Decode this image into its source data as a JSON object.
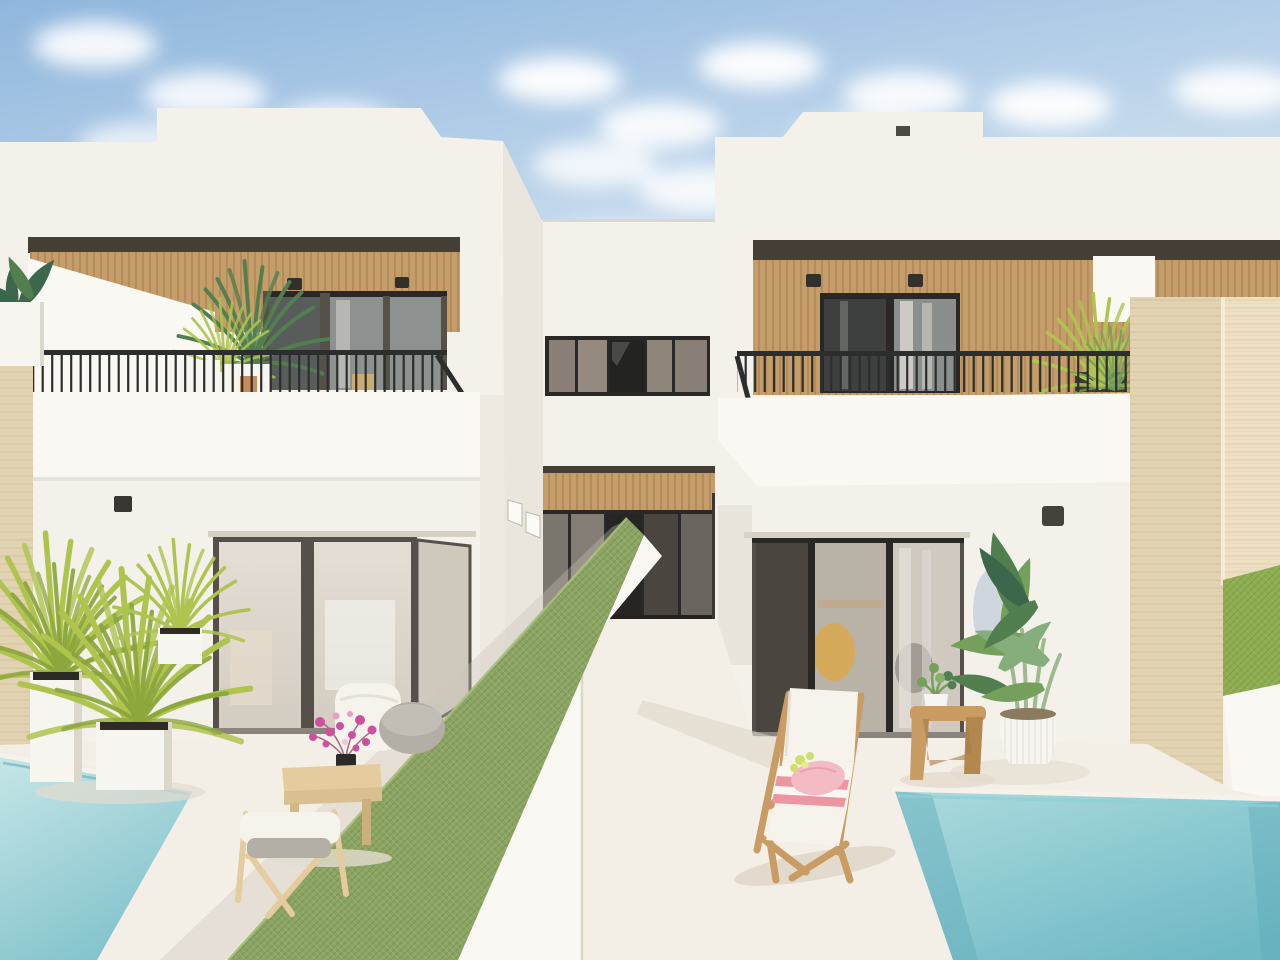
{
  "scene": {
    "description": "Architectural 3D rendering of two modern white Mediterranean townhouse villas with wood-slat clad balconies, black railings, private patios divided by a green privacy-mesh fence on a low white wall, small turquoise plunge pools in the lower corners, a travertine boundary wall on the right, potted plants, a wooden lounge chair with a pink towel, a small wooden stool and patio furniture under a blue sky with clouds",
    "labels": {
      "sky": "blue sky with white clouds",
      "left_villa": "left white villa with wood-clad balcony",
      "middle_villa": "recessed central unit with wood band and glass doors",
      "right_villa": "right white villa with wood-clad balcony",
      "privacy_fence": "green mesh privacy fence on low white dividing wall",
      "walkway": "central walkway between patios",
      "left_pool": "turquoise plunge pool bottom left",
      "right_pool": "turquoise plunge pool bottom right",
      "travertine_wall": "beige travertine boundary wall",
      "hedge": "green hedge strip behind right wall",
      "lounge_chair": "wooden sun lounger with white cushion and pink towel",
      "stool": "wooden side stool with small potted plant",
      "strelitzia": "large green plant in white ribbed pot",
      "armchair": "wooden armchair with white cushion",
      "coffee_table": "low wooden table with pink flowers in black vase",
      "planters": "white cube planters with yellow-green dracaena plants",
      "balcony_left": "left balcony with black railing and palms",
      "balcony_right": "right balcony with black railing and palm"
    }
  },
  "colors": {
    "sky_top": "#8fb6dd",
    "sky_mid": "#c2d8ec",
    "sky_low": "#eaf1f7",
    "cloud": "#ffffff",
    "wall": "#f4f1eb",
    "wall_bright": "#faf8f3",
    "wall_shade": "#eae5dd",
    "wall_dark": "#d9d3c9",
    "soffit": "#453f36",
    "wood": "#c49d6a",
    "wood_dark": "#96713f",
    "glass_dark": "#3f4241",
    "glass_mid": "#6e6a63",
    "glass_light": "#8d918f",
    "glass_pale_a": "#e5ded4",
    "glass_pale_b": "#d3ccc1",
    "frame": "#292826",
    "frame_brown": "#55504a",
    "rail": "#2c2e2e",
    "trav": "#ecdfc2",
    "trav_dark": "#e2d3b2",
    "trav_line": "#c9b48a",
    "trav_hi": "#f7eed9",
    "fence": "#8ca463",
    "fence_dark": "#6e8a47",
    "fence_hi": "#aabf82",
    "hedge": "#8fae4f",
    "pool_hi": "#c6e6e7",
    "pool": "#a9d9dd",
    "pool_deep": "#84c3cd",
    "pool_deep2": "#6fb9c5",
    "pool_dark": "#58a7b5",
    "floor": "#f4efe6",
    "floor_shade": "#dcd4c6",
    "wood_furn": "#c89c62",
    "wood_light": "#e5cc9e",
    "cushion": "#f6f3ec",
    "gray_cushion": "#b4afa6",
    "pink": "#f3bcc4",
    "pink_stripe": "#eb97a3",
    "magenta": "#ce4f9b",
    "plant_yellow": "#aec44f",
    "plant_yellow_dk": "#8aa43b",
    "plant_green": "#74a05c",
    "plant_green_dk": "#527f4f",
    "plant_deep": "#3d674b",
    "pot_white": "#f7f5f0",
    "soil": "#2e2a24"
  }
}
